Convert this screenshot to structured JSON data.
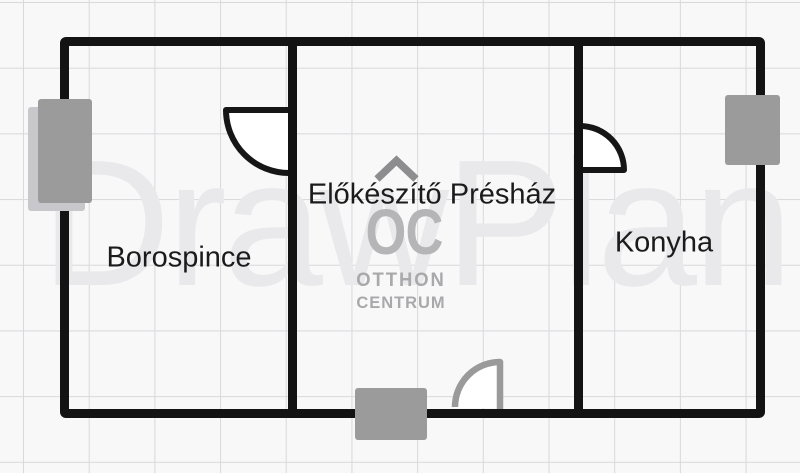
{
  "floorplan": {
    "watermark_text": "DrawPlan",
    "rooms": [
      {
        "label": "Borospince"
      },
      {
        "label": "Előkészítő Présház"
      },
      {
        "label": "Konyha"
      }
    ],
    "logo": {
      "monogram": "OC",
      "name_line1": "OTTHON",
      "name_line2": "CENTRUM"
    },
    "colors": {
      "wall": "#131313",
      "fixture_gray": "#9b9b9b",
      "fixture_shadow": "#c8c8cc",
      "entrance_door_gray": "#9a9a9a",
      "watermark": "#e9e9ec",
      "logo_gray": "#a9a9ab",
      "grid_line": "#d9d9dc",
      "background": "#f8f8f8",
      "label_text": "#1b1b1b"
    }
  }
}
